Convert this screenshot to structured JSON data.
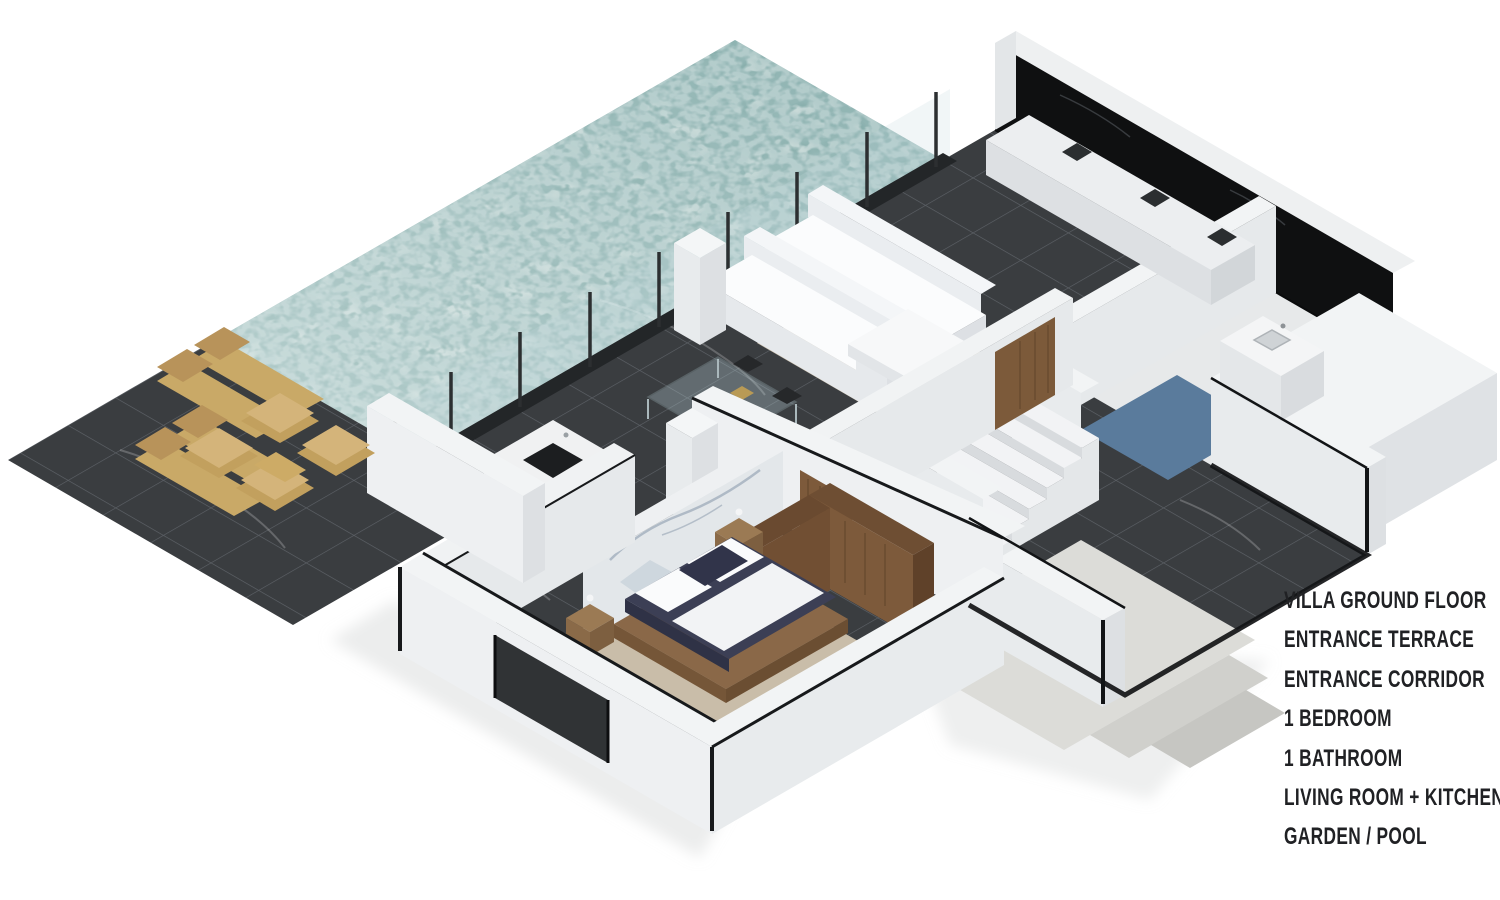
{
  "title": "Villa Ground Floor Plan Render",
  "legend": {
    "lines": [
      "VILLA GROUND FLOOR",
      "ENTRANCE TERRACE",
      "ENTRANCE CORRIDOR",
      "1 BEDROOM",
      "1 BATHROOM",
      "LIVING ROOM + KITCHEN",
      "GARDEN / POOL"
    ],
    "text_color": "#202124"
  },
  "scene": {
    "type": "isometric-3d-floor-plan",
    "rooms_shown": [
      "garden-pool",
      "entrance-terrace",
      "entrance-corridor",
      "bedroom",
      "bathroom",
      "living-room-kitchen"
    ],
    "colors": {
      "background": "#ffffff",
      "pool_water": "#7ca6a3",
      "tile_dark": "#3a3d40",
      "tile_grout": "#64696e",
      "wall_white": "#f2f4f5",
      "wall_shade": "#e3e6e9",
      "black_trim": "#121416",
      "wood_door": "#7d5a3b",
      "tan_outdoor_furniture": "#c9a967",
      "rug_beige": "#c9bda9",
      "bed_navy": "#3c3f55",
      "shower_blue": "#5a7b9c",
      "concrete_light": "#dcdcd8",
      "marble_light": "#e9eaec"
    },
    "objects": [
      "pool",
      "sun-loungers",
      "outdoor-armchair-set",
      "glass-pool-fence",
      "sofas",
      "coffee-table",
      "glass-side-table",
      "kitchen-island",
      "kitchen-counter-appliances",
      "staircase",
      "wood-doors",
      "bathroom-vanity",
      "shower-floor",
      "double-bed",
      "nightstands",
      "wardrobe",
      "marble-accent-wall",
      "entrance-steps"
    ]
  }
}
